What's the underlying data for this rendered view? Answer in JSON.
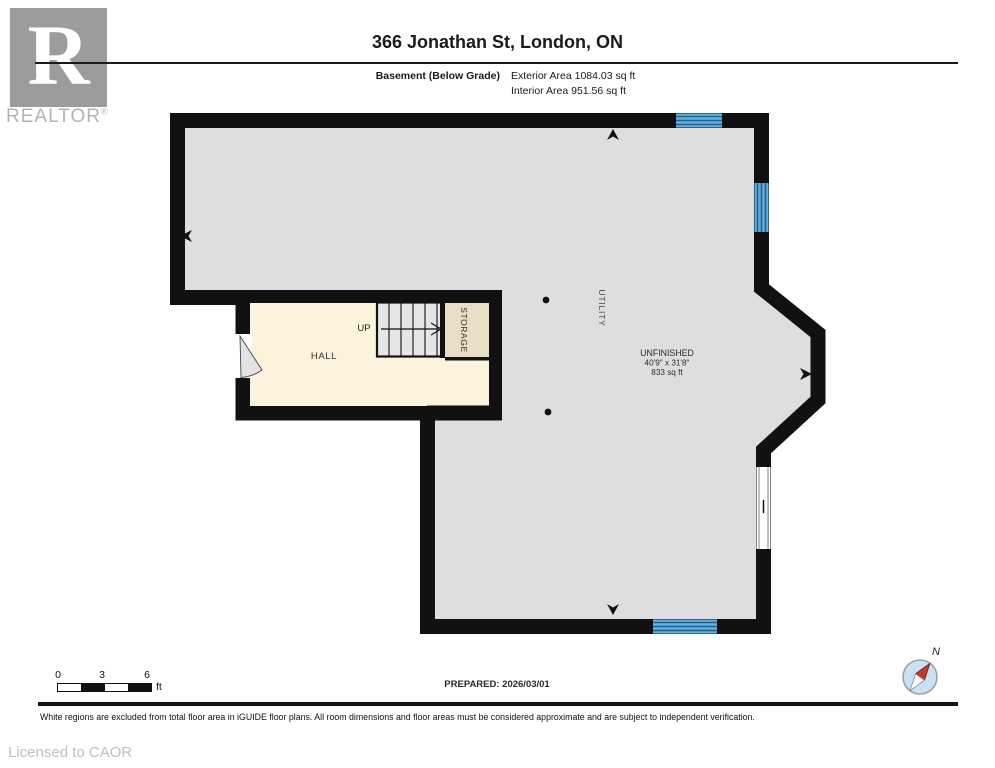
{
  "header": {
    "logo": {
      "letter": "R",
      "brand": "REALTOR",
      "registered": "®"
    },
    "title": "366 Jonathan St, London, ON",
    "floor_label": "Basement (Below Grade)",
    "exterior_area": "Exterior Area 1084.03 sq ft",
    "interior_area": "Interior Area 951.56 sq ft"
  },
  "plan": {
    "labels": {
      "hall": "HALL",
      "storage": "STORAGE",
      "utility": "UTILITY",
      "up": "UP",
      "unfinished_name": "UNFINISHED",
      "unfinished_dimensions": "40'9\" x 31'8\"",
      "unfinished_area": "833 sq ft"
    },
    "colors": {
      "wall": "#111111",
      "interior_gray": "#dedede",
      "hall_cream": "#fbf3dc",
      "storage_beige": "#e9dfc7",
      "stairs_gray": "#e6e6e6",
      "window_blue": "#5fb3e3",
      "window_line": "#2a5d85",
      "door_swing": "#e3e3e3"
    }
  },
  "footer": {
    "scale": {
      "ticks": [
        "0",
        "3",
        "6"
      ],
      "unit": "ft"
    },
    "prepared": "PREPARED: 2026/03/01",
    "compass_label": "N",
    "disclaimer": "White regions are excluded from total floor area in iGUIDE floor plans. All room dimensions and floor areas must be considered approximate and are subject to independent verification.",
    "license": "Licensed to CAOR"
  }
}
